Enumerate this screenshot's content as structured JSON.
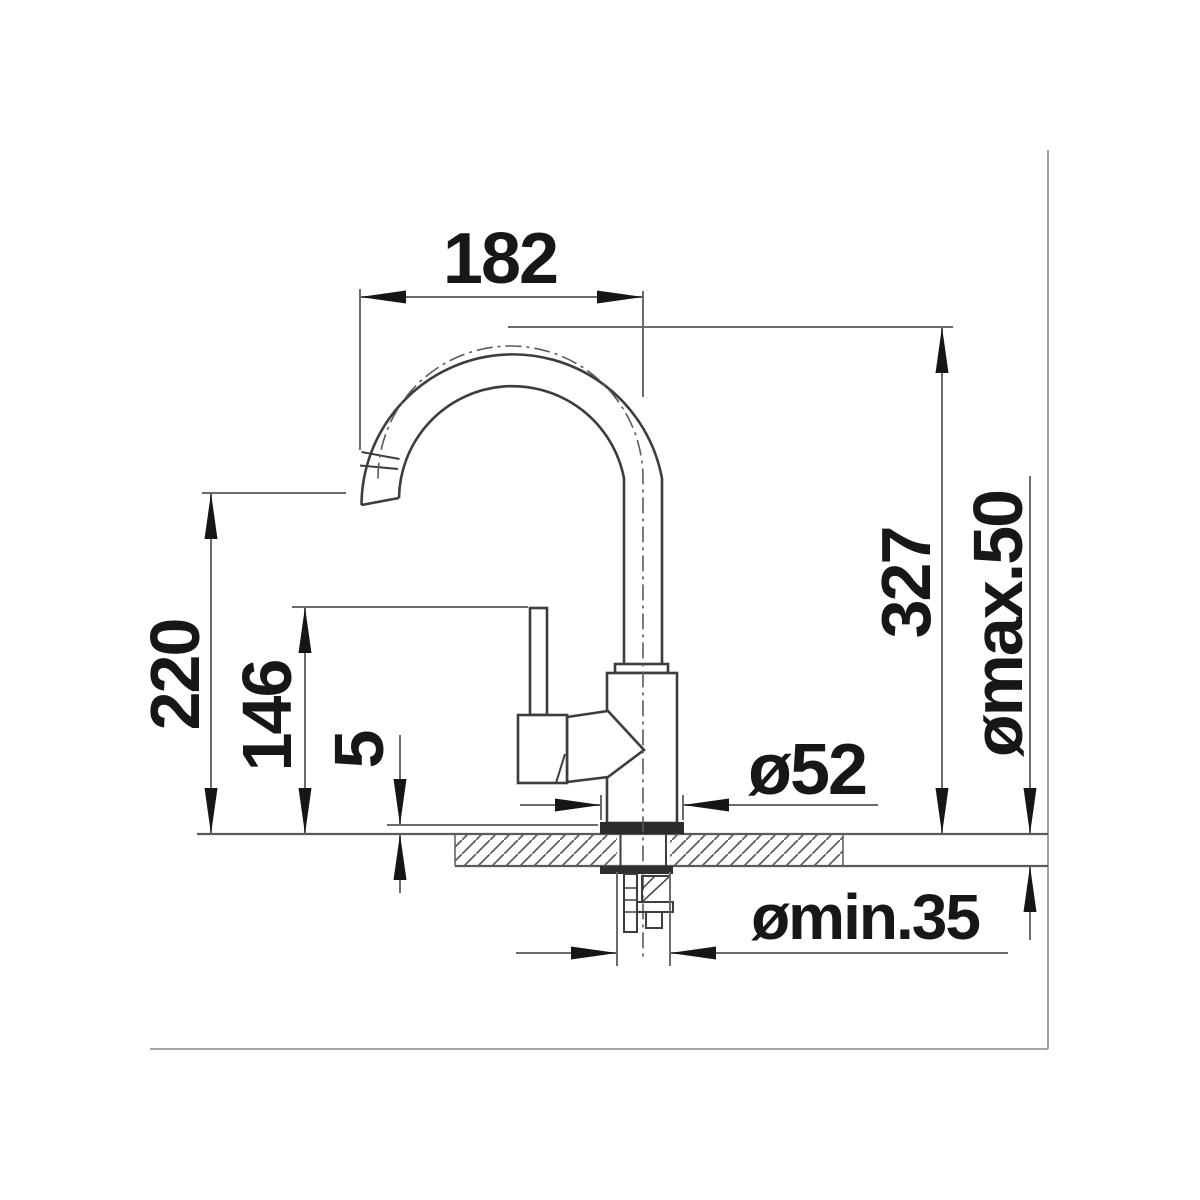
{
  "drawing": {
    "type": "faucet installation dimension drawing",
    "labels": {
      "spout_reach": "182",
      "total_height": "327",
      "clamp_range": "ømax.50",
      "outlet_height": "220",
      "handle_height": "146",
      "plate_height": "5",
      "base_diameter": "ø52",
      "hole_diameter_min": "ømin.35"
    },
    "colors": {
      "outline": "#3d3d3d",
      "dimension_lines": "#6b6b6b",
      "arrows_text": "#171717",
      "border": "#8a8a8a",
      "background": "#ffffff"
    }
  }
}
